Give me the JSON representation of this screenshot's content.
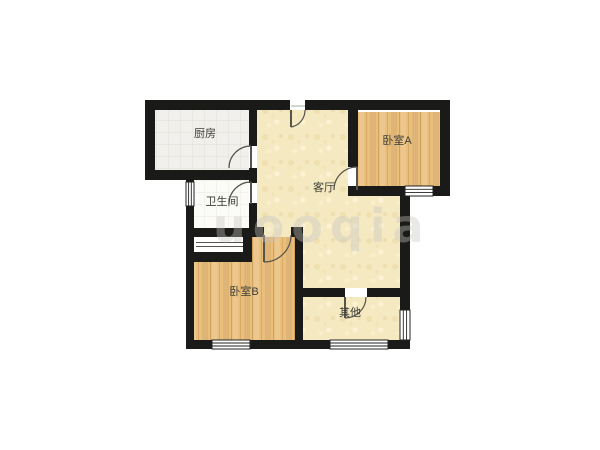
{
  "canvas": {
    "width": 600,
    "height": 450,
    "background": "#ffffff"
  },
  "watermark": {
    "text": "uooqia"
  },
  "colors": {
    "wall": "#1a1a18",
    "floor-cream": "#f5e9c2",
    "floor-wood": "#eabf7c",
    "floor-kitchen": "#f1f0ec",
    "floor-bath": "#fbfbf7",
    "label": "#3f3f38",
    "door": "#55534c",
    "window-line": "#222222",
    "watermark": "#c8c6c1"
  },
  "rooms": [
    {
      "id": "kitchen",
      "label": "厨房"
    },
    {
      "id": "bathroom",
      "label": "卫生间"
    },
    {
      "id": "living",
      "label": "客厅"
    },
    {
      "id": "bedroom-a",
      "label": "卧室A"
    },
    {
      "id": "bedroom-b",
      "label": "卧室B"
    },
    {
      "id": "other",
      "label": "其他"
    }
  ]
}
